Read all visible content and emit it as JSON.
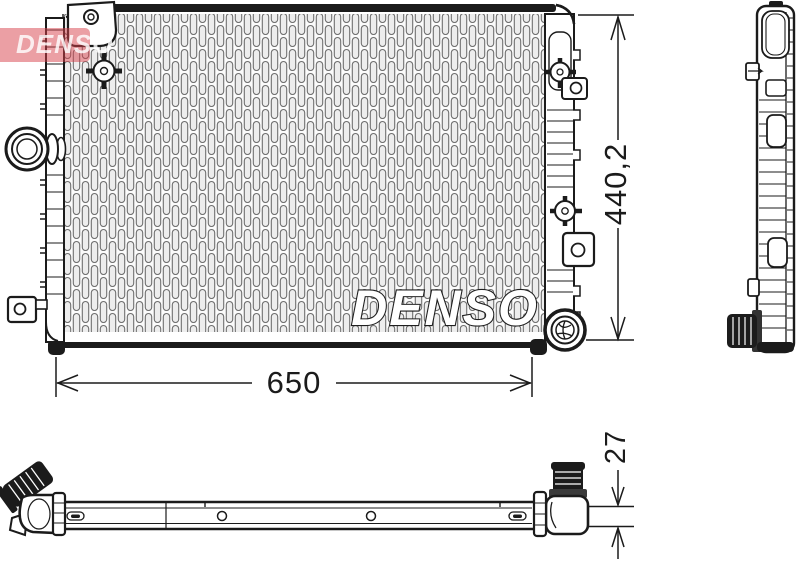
{
  "brand_logo": {
    "text": "DENSO"
  },
  "watermark": {
    "text": "DENSO"
  },
  "dimensions": {
    "width": "650",
    "height": "440,2",
    "depth": "27"
  },
  "colors": {
    "line": "#1b1b1b",
    "logo_red": "#d8404a",
    "fin_gray": "#6f6f6f"
  }
}
